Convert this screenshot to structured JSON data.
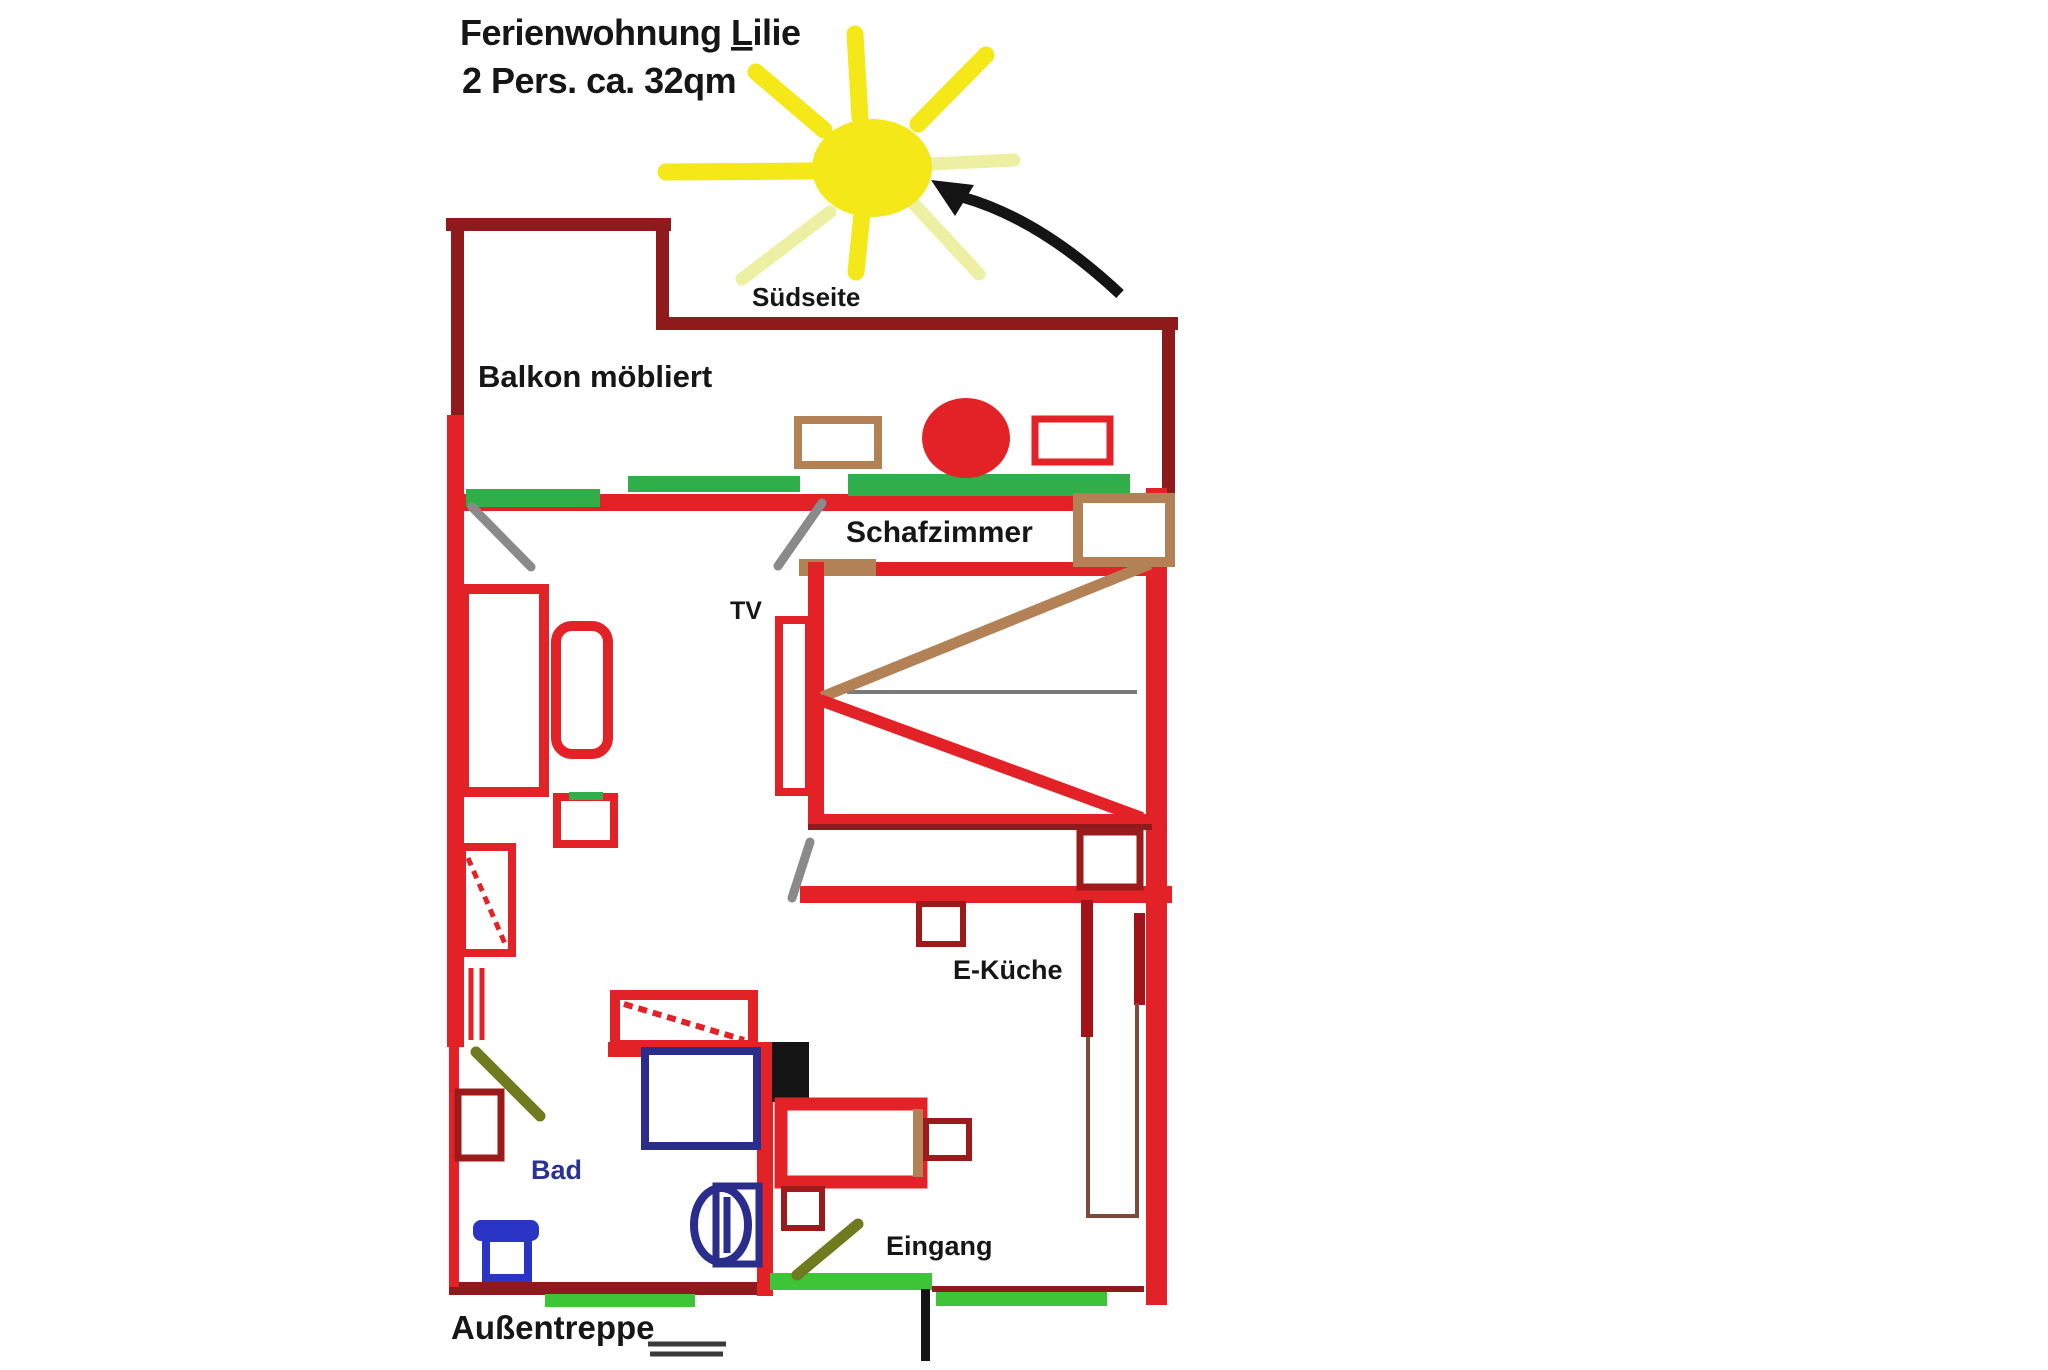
{
  "title": {
    "line1_pre": "Ferienwohnung ",
    "line1_underlined": "L",
    "line1_rest": "ilie",
    "line2": "2 Pers. ca. 32qm"
  },
  "labels": {
    "south_side": "Südseite",
    "balcony": "Balkon möbliert",
    "bedroom": "Schafzimmer",
    "tv": "TV",
    "kitchen": "E-Küche",
    "bathroom": "Bad",
    "entrance": "Eingang",
    "outdoor_stairs": "Außentreppe"
  },
  "colors": {
    "wall_red": "#e32227",
    "wall_maroon": "#8e1a1c",
    "dark_red": "#a31218",
    "outline_darkred": "#9c1a1a",
    "green_window": "#2fae49",
    "green_step": "#3ec437",
    "furniture_brown": "#b28156",
    "counter_brown": "#7d4a3e",
    "fixture_blue": "#2b2d8c",
    "toilet_blue": "#2b35c5",
    "bad_text_blue": "#2b3390",
    "sun_yellow": "#f4e818",
    "sun_pale": "#edf0a2",
    "swing_gray": "#8a8a8a",
    "swing_olive": "#6e7b1e",
    "ink_black": "#141414"
  }
}
